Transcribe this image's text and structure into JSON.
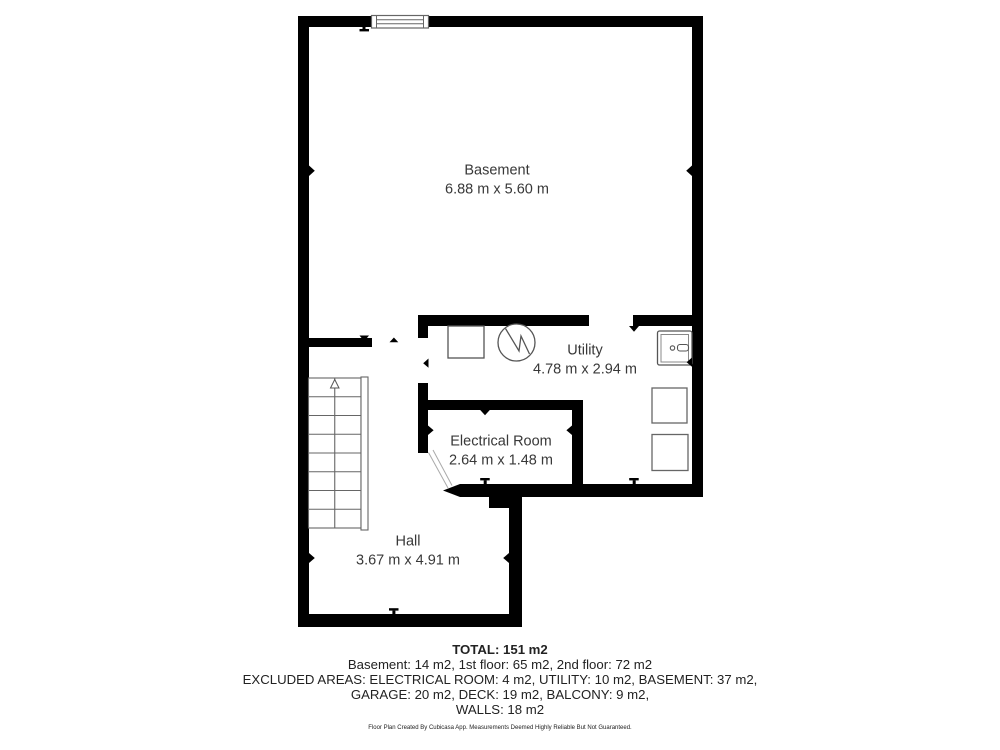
{
  "floorplan": {
    "title": "Basement floor plan",
    "rooms": [
      {
        "id": "basement",
        "name": "Basement",
        "dims": "6.88 m x 5.60 m"
      },
      {
        "id": "utility",
        "name": "Utility",
        "dims": "4.78 m x 2.94 m"
      },
      {
        "id": "electrical",
        "name": "Electrical Room",
        "dims": "2.64 m x 1.48 m"
      },
      {
        "id": "hall",
        "name": "Hall",
        "dims": "3.67 m x 4.91 m"
      }
    ],
    "summary": {
      "total": "TOTAL: 151 m2",
      "lines": [
        "Basement: 14 m2, 1st floor: 65 m2, 2nd floor: 72 m2",
        "EXCLUDED AREAS: ELECTRICAL ROOM: 4 m2, UTILITY: 10 m2, BASEMENT: 37 m2,",
        "GARAGE: 20 m2, DECK: 19 m2, BALCONY: 9 m2,",
        "WALLS: 18 m2"
      ]
    },
    "footer": "Floor Plan Created By Cubicasa App. Measurements Deemed Highly Reliable But Not Guaranteed.",
    "icons": {
      "water_heater": "circle-with-zigzag",
      "washer": "square-outline",
      "sink": "square-with-faucet",
      "storage_box_1": "square-outline",
      "storage_box_2": "square-outline",
      "window": "double-line-window",
      "stairs": "staircase-with-up-arrow",
      "door_direction_arrow": "solid-left-triangle"
    },
    "colors": {
      "wall": "#000000",
      "fixture_outline": "#555555",
      "label_text": "#383838",
      "summary_text": "#222222",
      "background": "#ffffff"
    }
  }
}
